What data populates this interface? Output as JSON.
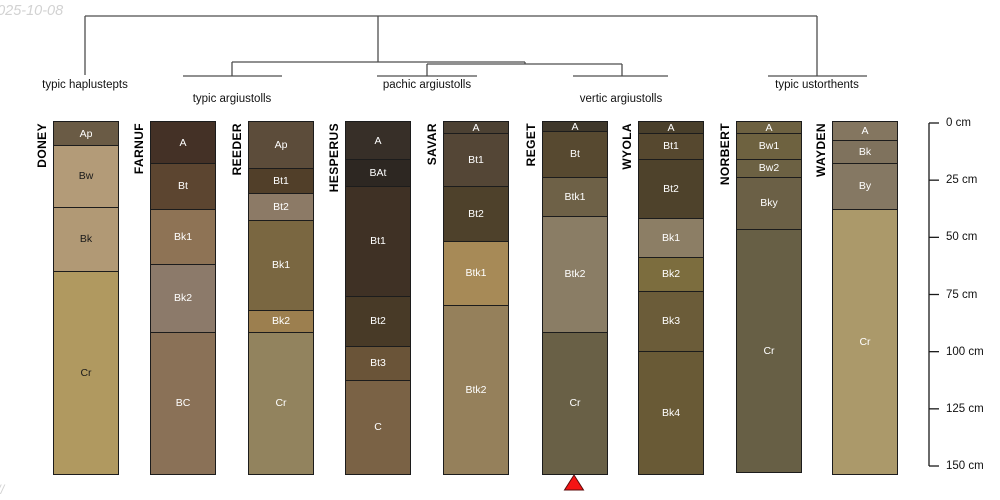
{
  "watermarks": {
    "top_left": "2025-10-08",
    "bottom_left": "//"
  },
  "colors": {
    "horizon_border": "#1c1c1c",
    "tree_line": "#4d4d4d",
    "axis_line": "#1a1a1a",
    "marker_fill": "#f51414",
    "marker_stroke": "#5c0b0b",
    "label_light": "#ffffff",
    "label_dark": "#1a1a1a"
  },
  "chart_data": {
    "type": "soil-profile-dendrogram",
    "depth_axis": {
      "unit": "cm",
      "tick_values": [
        0,
        25,
        50,
        75,
        100,
        125,
        150
      ],
      "tick_labels": [
        "0 cm",
        "25 cm",
        "50 cm",
        "75 cm",
        "100 cm",
        "125 cm",
        "150 cm"
      ]
    },
    "taxa": [
      {
        "label": "typic haplustepts",
        "profiles": [
          "DONEY"
        ]
      },
      {
        "label": "typic argiustolls",
        "profiles": [
          "FARNUF",
          "REEDER"
        ]
      },
      {
        "label": "pachic argiustolls",
        "profiles": [
          "HESPERUS",
          "SAVAR"
        ]
      },
      {
        "label": "vertic argiustolls",
        "profiles": [
          "REGET",
          "WYOLA"
        ]
      },
      {
        "label": "typic ustorthents",
        "profiles": [
          "NORBERT",
          "WAYDEN"
        ]
      }
    ],
    "profiles": [
      {
        "id": "DONEY",
        "horizons": [
          {
            "name": "Ap",
            "top": 0,
            "bottom": 10,
            "color": "#6a5b45",
            "text": "#ffffff"
          },
          {
            "name": "Bw",
            "top": 10,
            "bottom": 37,
            "color": "#b39b78",
            "text": "#1a1a1a"
          },
          {
            "name": "Bk",
            "top": 37,
            "bottom": 65,
            "color": "#b19975",
            "text": "#1a1a1a"
          },
          {
            "name": "Cr",
            "top": 65,
            "bottom": 154,
            "color": "#b09960",
            "text": "#1a1a1a"
          }
        ]
      },
      {
        "id": "FARNUF",
        "horizons": [
          {
            "name": "A",
            "top": 0,
            "bottom": 18,
            "color": "#443126",
            "text": "#ffffff"
          },
          {
            "name": "Bt",
            "top": 18,
            "bottom": 38,
            "color": "#5c4530",
            "text": "#ffffff"
          },
          {
            "name": "Bk1",
            "top": 38,
            "bottom": 62,
            "color": "#8e7355",
            "text": "#ffffff"
          },
          {
            "name": "Bk2",
            "top": 62,
            "bottom": 92,
            "color": "#8c7a6a",
            "text": "#ffffff"
          },
          {
            "name": "BC",
            "top": 92,
            "bottom": 154,
            "color": "#8a7157",
            "text": "#ffffff"
          }
        ]
      },
      {
        "id": "REEDER",
        "horizons": [
          {
            "name": "Ap",
            "top": 0,
            "bottom": 20,
            "color": "#5c4c3a",
            "text": "#ffffff"
          },
          {
            "name": "Bt1",
            "top": 20,
            "bottom": 31,
            "color": "#513f29",
            "text": "#ffffff"
          },
          {
            "name": "Bt2",
            "top": 31,
            "bottom": 43,
            "color": "#8c7a66",
            "text": "#ffffff"
          },
          {
            "name": "Bk1",
            "top": 43,
            "bottom": 82,
            "color": "#7a6741",
            "text": "#ffffff"
          },
          {
            "name": "Bk2",
            "top": 82,
            "bottom": 92,
            "color": "#9c7f4f",
            "text": "#ffffff"
          },
          {
            "name": "Cr",
            "top": 92,
            "bottom": 154,
            "color": "#92835e",
            "text": "#ffffff"
          }
        ]
      },
      {
        "id": "HESPERUS",
        "horizons": [
          {
            "name": "A",
            "top": 0,
            "bottom": 16,
            "color": "#372f28",
            "text": "#ffffff"
          },
          {
            "name": "BAt",
            "top": 16,
            "bottom": 28,
            "color": "#2d2722",
            "text": "#ffffff"
          },
          {
            "name": "Bt1",
            "top": 28,
            "bottom": 76,
            "color": "#3f3125",
            "text": "#ffffff"
          },
          {
            "name": "Bt2",
            "top": 76,
            "bottom": 98,
            "color": "#483a27",
            "text": "#ffffff"
          },
          {
            "name": "Bt3",
            "top": 98,
            "bottom": 113,
            "color": "#6a5438",
            "text": "#ffffff"
          },
          {
            "name": "C",
            "top": 113,
            "bottom": 154,
            "color": "#7a6245",
            "text": "#ffffff"
          }
        ]
      },
      {
        "id": "SAVAR",
        "horizons": [
          {
            "name": "A",
            "top": 0,
            "bottom": 5,
            "color": "#4c4133",
            "text": "#ffffff"
          },
          {
            "name": "Bt1",
            "top": 5,
            "bottom": 28,
            "color": "#544636",
            "text": "#ffffff"
          },
          {
            "name": "Bt2",
            "top": 28,
            "bottom": 52,
            "color": "#4e412b",
            "text": "#ffffff"
          },
          {
            "name": "Btk1",
            "top": 52,
            "bottom": 80,
            "color": "#a78a57",
            "text": "#ffffff"
          },
          {
            "name": "Btk2",
            "top": 80,
            "bottom": 154,
            "color": "#95805b",
            "text": "#ffffff"
          }
        ]
      },
      {
        "id": "REGET",
        "horizons": [
          {
            "name": "A",
            "top": 0,
            "bottom": 4,
            "color": "#3f382b",
            "text": "#ffffff"
          },
          {
            "name": "Bt",
            "top": 4,
            "bottom": 24,
            "color": "#574930",
            "text": "#ffffff"
          },
          {
            "name": "Btk1",
            "top": 24,
            "bottom": 41,
            "color": "#6e6147",
            "text": "#ffffff"
          },
          {
            "name": "Btk2",
            "top": 41,
            "bottom": 92,
            "color": "#8a7d65",
            "text": "#ffffff"
          },
          {
            "name": "Cr",
            "top": 92,
            "bottom": 154,
            "color": "#696046",
            "text": "#ffffff"
          }
        ]
      },
      {
        "id": "WYOLA",
        "horizons": [
          {
            "name": "A",
            "top": 0,
            "bottom": 5,
            "color": "#493f2b",
            "text": "#ffffff"
          },
          {
            "name": "Bt1",
            "top": 5,
            "bottom": 16,
            "color": "#56482f",
            "text": "#ffffff"
          },
          {
            "name": "Bt2",
            "top": 16,
            "bottom": 42,
            "color": "#4e422b",
            "text": "#ffffff"
          },
          {
            "name": "Bk1",
            "top": 42,
            "bottom": 59,
            "color": "#8c7e65",
            "text": "#ffffff"
          },
          {
            "name": "Bk2",
            "top": 59,
            "bottom": 74,
            "color": "#7c6d3e",
            "text": "#ffffff"
          },
          {
            "name": "Bk3",
            "top": 74,
            "bottom": 100,
            "color": "#6b5c39",
            "text": "#ffffff"
          },
          {
            "name": "Bk4",
            "top": 100,
            "bottom": 154,
            "color": "#695a36",
            "text": "#ffffff"
          }
        ]
      },
      {
        "id": "NORBERT",
        "horizons": [
          {
            "name": "A",
            "top": 0,
            "bottom": 5,
            "color": "#6d6141",
            "text": "#ffffff"
          },
          {
            "name": "Bw1",
            "top": 5,
            "bottom": 16,
            "color": "#6e6240",
            "text": "#ffffff"
          },
          {
            "name": "Bw2",
            "top": 16,
            "bottom": 24,
            "color": "#6c6143",
            "text": "#ffffff"
          },
          {
            "name": "Bky",
            "top": 24,
            "bottom": 47,
            "color": "#6b6046",
            "text": "#ffffff"
          },
          {
            "name": "Cr",
            "top": 47,
            "bottom": 153,
            "color": "#675f45",
            "text": "#ffffff"
          }
        ]
      },
      {
        "id": "WAYDEN",
        "horizons": [
          {
            "name": "A",
            "top": 0,
            "bottom": 8,
            "color": "#847660",
            "text": "#ffffff"
          },
          {
            "name": "Bk",
            "top": 8,
            "bottom": 18,
            "color": "#7f725d",
            "text": "#ffffff"
          },
          {
            "name": "By",
            "top": 18,
            "bottom": 38,
            "color": "#857863",
            "text": "#ffffff"
          },
          {
            "name": "Cr",
            "top": 38,
            "bottom": 154,
            "color": "#ab996a",
            "text": "#ffffff"
          }
        ]
      }
    ],
    "marker": {
      "shape": "triangle-up",
      "profile": "REGET"
    }
  }
}
